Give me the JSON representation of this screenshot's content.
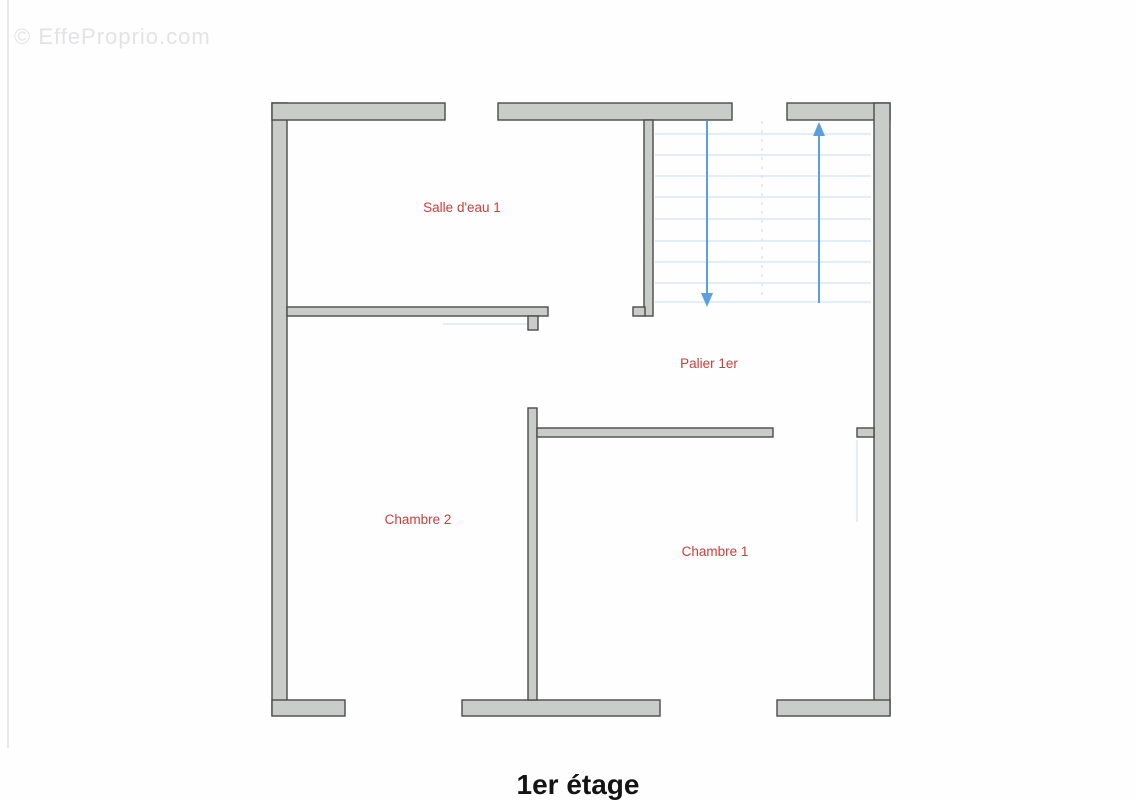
{
  "page": {
    "watermark": "© EffeProprio.com",
    "title": "1er étage"
  },
  "rooms": {
    "salle_deau_1": {
      "label": "Salle d'eau 1"
    },
    "palier_1er": {
      "label": "Palier 1er"
    },
    "chambre_2": {
      "label": "Chambre 2"
    },
    "chambre_1": {
      "label": "Chambre 1"
    }
  },
  "stairs": {
    "down_arrow_icon": "arrow-down",
    "up_arrow_icon": "arrow-up",
    "tread_count": 9
  },
  "colors": {
    "room_label": "#d23a3a",
    "wall_fill": "#c9cdca",
    "wall_outline": "#4a4a4a",
    "stair_arrow": "#5b9fe0",
    "stair_tread": "#d7e7f6",
    "swing_line": "#cfe4f7",
    "title_text": "#141414",
    "watermark_text": "#e3e3e6",
    "page_bg": "#fefefe",
    "scan_line": "#e0e0e3"
  }
}
